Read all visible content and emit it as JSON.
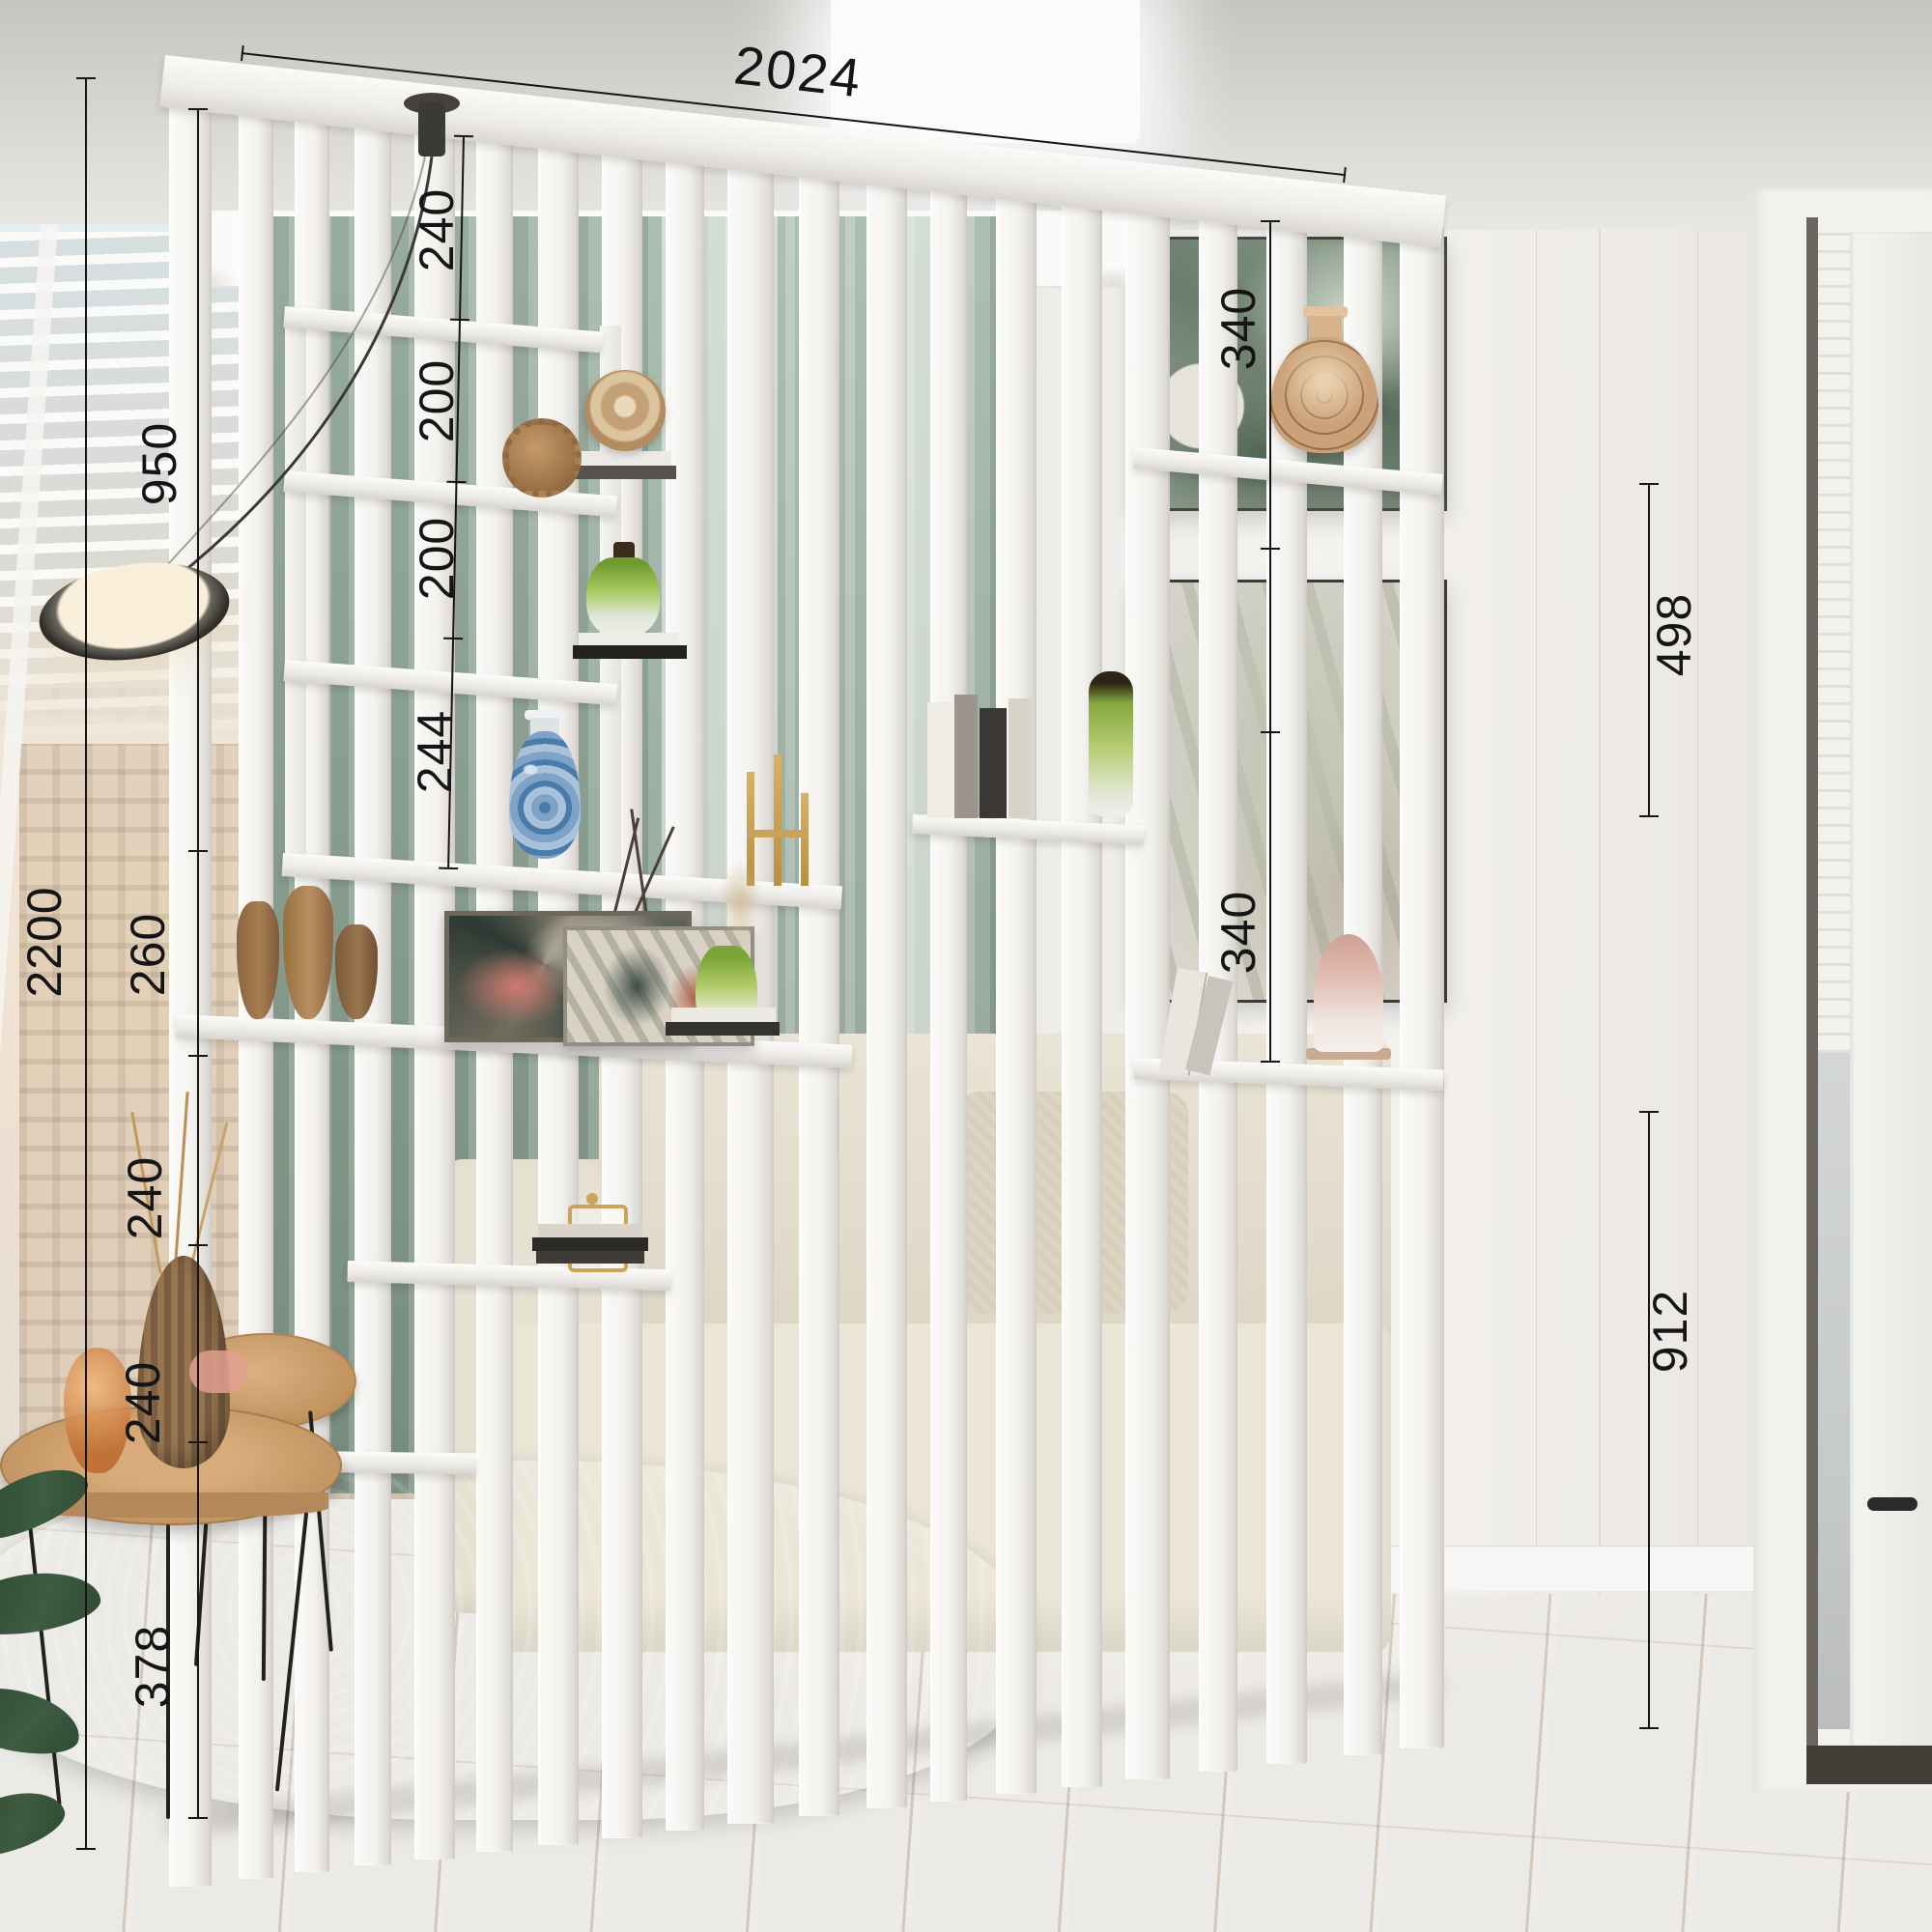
{
  "dimensions": {
    "overall_width": "2024",
    "overall_height": "2200",
    "upper_left_height": "950",
    "left_shelf_segments": [
      "240",
      "200",
      "200",
      "244"
    ],
    "left_lower_segments": [
      "260",
      "240",
      "240",
      "378"
    ],
    "right_inner_segments": [
      "340",
      "340"
    ],
    "right_outer_segments": [
      "498",
      "912"
    ]
  },
  "palette": {
    "divider_white": "#f6f5f2",
    "curtain_green": "#9db2a3",
    "floor_wood": "#d8b88c",
    "sofa_beige": "#e8e2d4",
    "rug_grey": "#979ca0",
    "accent_wood": "#c79a67",
    "dimension_line": "#151515"
  }
}
